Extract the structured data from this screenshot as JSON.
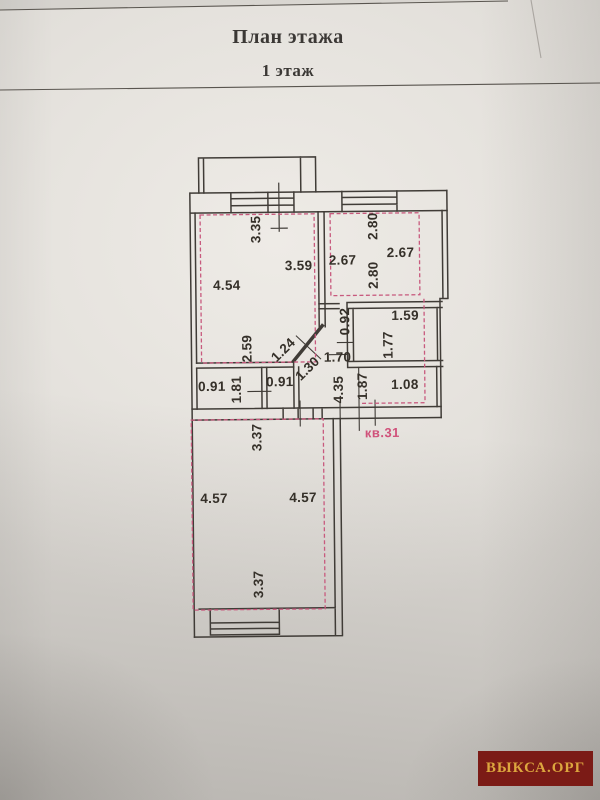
{
  "page": {
    "title": "План этажа",
    "subtitle": "1 этаж",
    "apartment_label": "кв.31",
    "watermark": "ВЫКСА.ОРГ"
  },
  "plan": {
    "dimension_labels": [
      {
        "text": "3.35",
        "x": 258,
        "y": 229,
        "rot": -90
      },
      {
        "text": "4.54",
        "x": 228,
        "y": 285,
        "rot": 0
      },
      {
        "text": "3.59",
        "x": 300,
        "y": 266,
        "rot": 0
      },
      {
        "text": "2.67",
        "x": 344,
        "y": 261,
        "rot": 0
      },
      {
        "text": "2.80",
        "x": 375,
        "y": 227,
        "rot": -90
      },
      {
        "text": "2.67",
        "x": 402,
        "y": 254,
        "rot": 0
      },
      {
        "text": "2.80",
        "x": 375,
        "y": 276,
        "rot": -90
      },
      {
        "text": "2.59",
        "x": 248,
        "y": 348,
        "rot": -90
      },
      {
        "text": "0.92",
        "x": 346,
        "y": 322,
        "rot": -90
      },
      {
        "text": "1.59",
        "x": 406,
        "y": 317,
        "rot": 0
      },
      {
        "text": "1.77",
        "x": 389,
        "y": 346,
        "rot": -90
      },
      {
        "text": "1.24",
        "x": 284,
        "y": 350,
        "rot": -44
      },
      {
        "text": "1.30",
        "x": 308,
        "y": 369,
        "rot": -44
      },
      {
        "text": "1.70",
        "x": 338,
        "y": 358,
        "rot": 0
      },
      {
        "text": "0.91",
        "x": 212,
        "y": 386,
        "rot": 0
      },
      {
        "text": "1.81",
        "x": 237,
        "y": 389,
        "rot": -90
      },
      {
        "text": "0.91",
        "x": 280,
        "y": 382,
        "rot": 0
      },
      {
        "text": "4.35",
        "x": 339,
        "y": 390,
        "rot": -90
      },
      {
        "text": "1.87",
        "x": 363,
        "y": 387,
        "rot": -90
      },
      {
        "text": "1.08",
        "x": 405,
        "y": 386,
        "rot": 0
      },
      {
        "text": "3.37",
        "x": 257,
        "y": 437,
        "rot": -90
      },
      {
        "text": "4.57",
        "x": 213,
        "y": 498,
        "rot": 0
      },
      {
        "text": "4.57",
        "x": 302,
        "y": 498,
        "rot": 0
      },
      {
        "text": "3.37",
        "x": 257,
        "y": 584,
        "rot": -90
      }
    ]
  },
  "colors": {
    "wall_line": "#403c37",
    "outline_pink": "#c85a7e",
    "label_pink": "#d0517a",
    "watermark_bg": "#7b1b16",
    "watermark_text": "#dca63e"
  }
}
